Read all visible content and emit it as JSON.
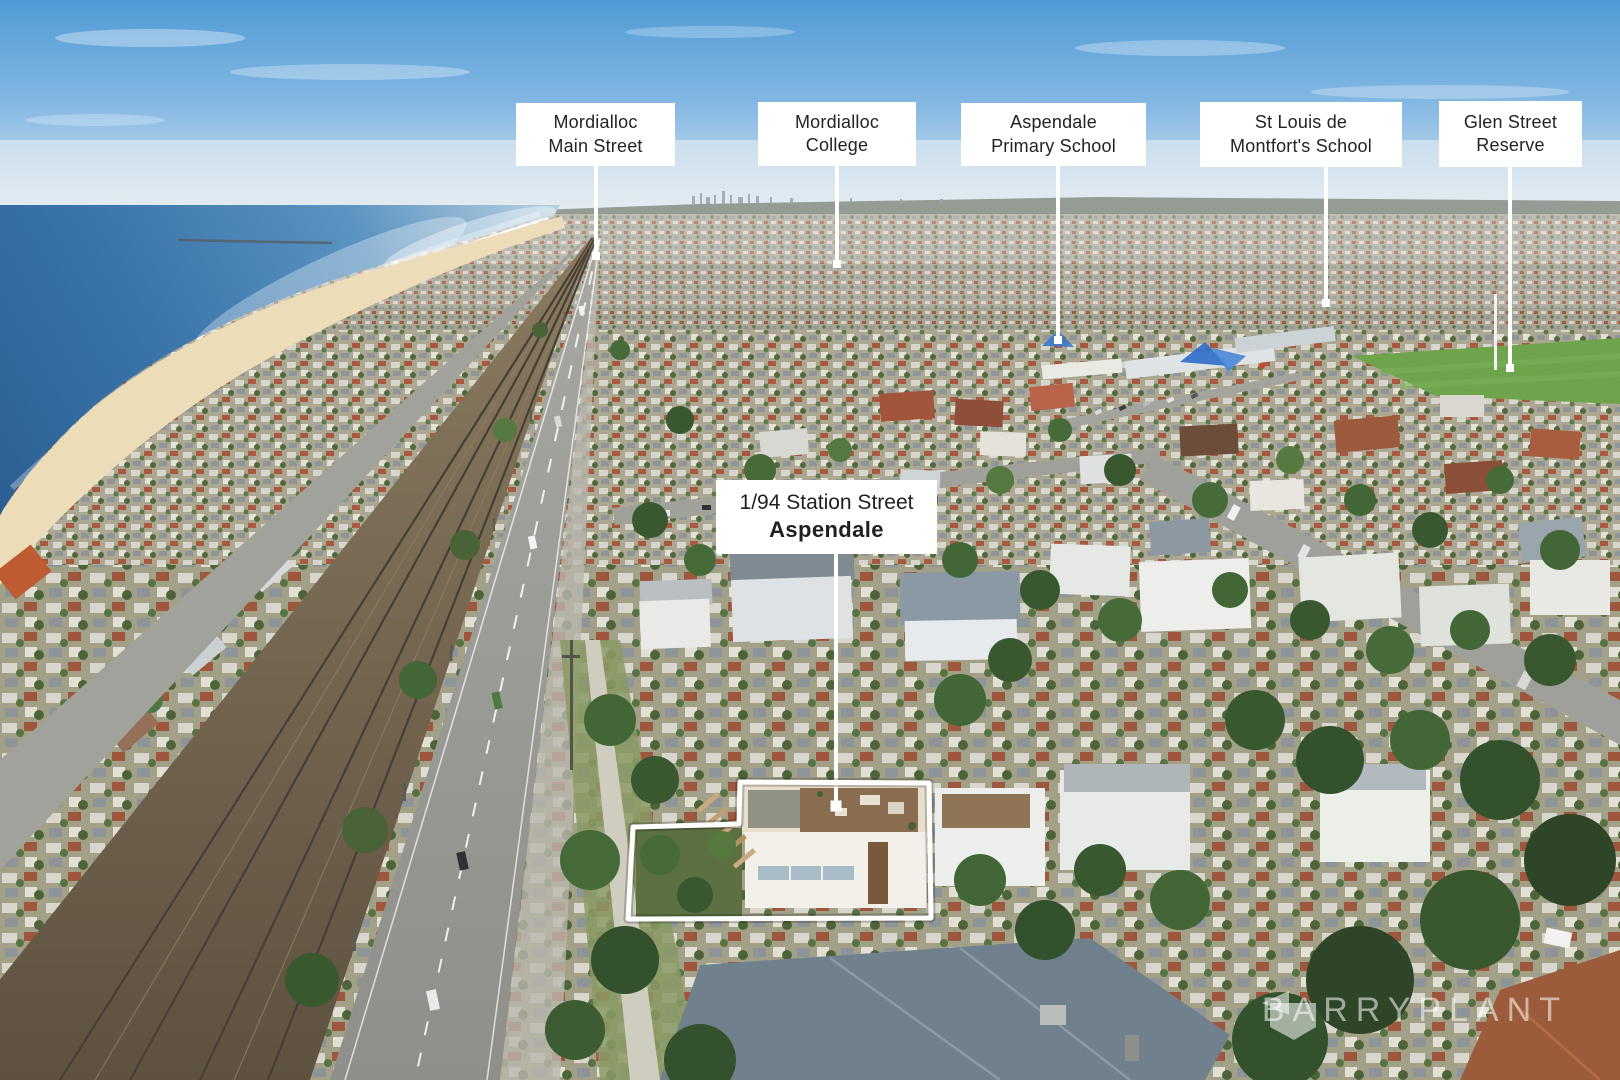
{
  "location_labels": [
    {
      "id": "mordialloc-main-street",
      "line1": "Mordialloc",
      "line2": "Main Street"
    },
    {
      "id": "mordialloc-college",
      "line1": "Mordialloc",
      "line2": "College"
    },
    {
      "id": "aspendale-primary",
      "line1": "Aspendale",
      "line2": "Primary School"
    },
    {
      "id": "st-louis-de-montfort",
      "line1": "St Louis de",
      "line2": "Montfort's School"
    },
    {
      "id": "glen-street-reserve",
      "line1": "Glen Street",
      "line2": "Reserve"
    }
  ],
  "property_label": {
    "line1": "1/94 Station Street",
    "line2": "Aspendale"
  },
  "watermark": {
    "brand": "BARRYPLANT",
    "icon": "barry-plant-flag-icon"
  },
  "colors": {
    "label_background": "#ffffff",
    "label_text": "#232323",
    "annotation_line": "#ffffff",
    "sky_top": "#549fd7",
    "sea_deep": "#2c5f93",
    "sand": "#ecdcb8",
    "reserve_green": "#6da44c",
    "watermark_white": "rgba(255,255,255,0.55)"
  }
}
